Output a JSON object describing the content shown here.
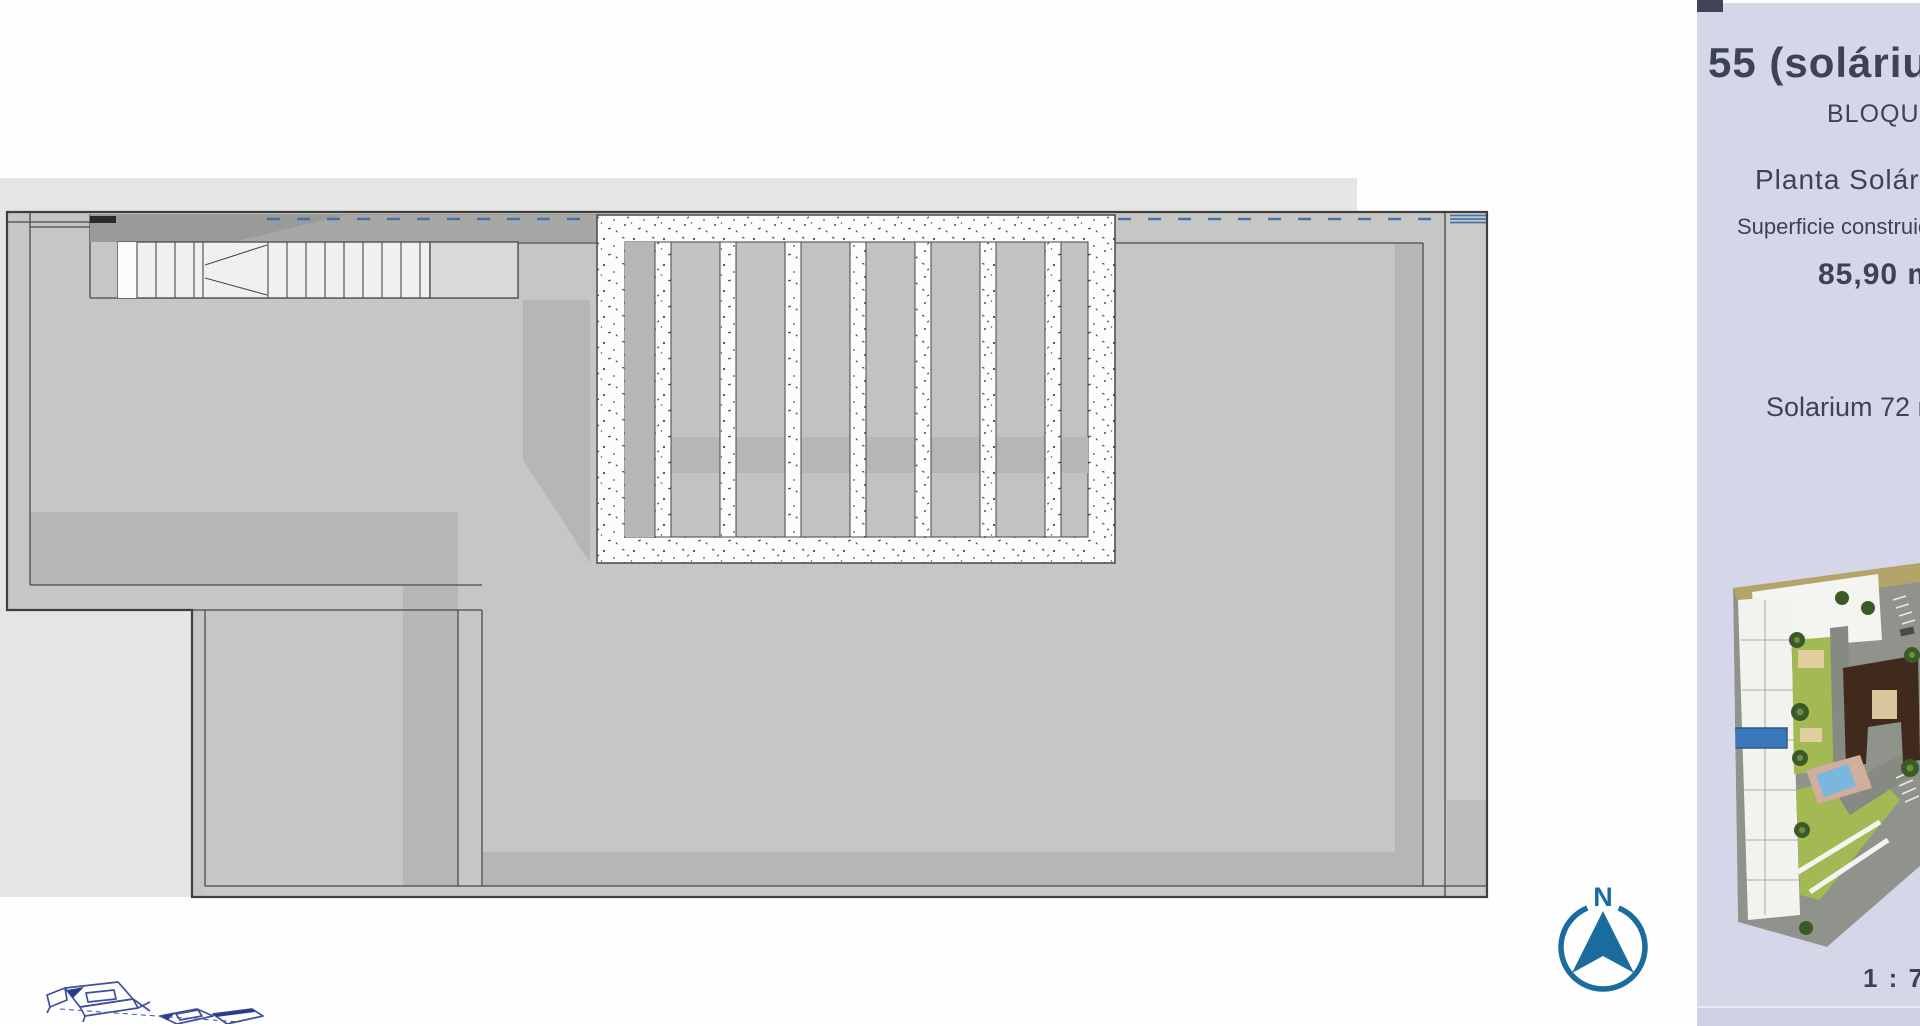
{
  "panel": {
    "unit_title": "55 (solárium",
    "block_label": "BLOQUE",
    "floor_label": "Planta Solárium",
    "surface_label": "Superficie construida",
    "surface_value": "85,90 m",
    "solarium_value": "Solarium 72 m",
    "scale_label": "1 : 7"
  },
  "compass": {
    "north_label": "N"
  },
  "colors": {
    "accent_blue": "#3a78bb",
    "compass_blue": "#1a6c9e",
    "railing_blue": "#4673a5",
    "panel_background": "#d6d6e9",
    "text_dark": "#2b3144",
    "text_medium": "#3c4358"
  }
}
